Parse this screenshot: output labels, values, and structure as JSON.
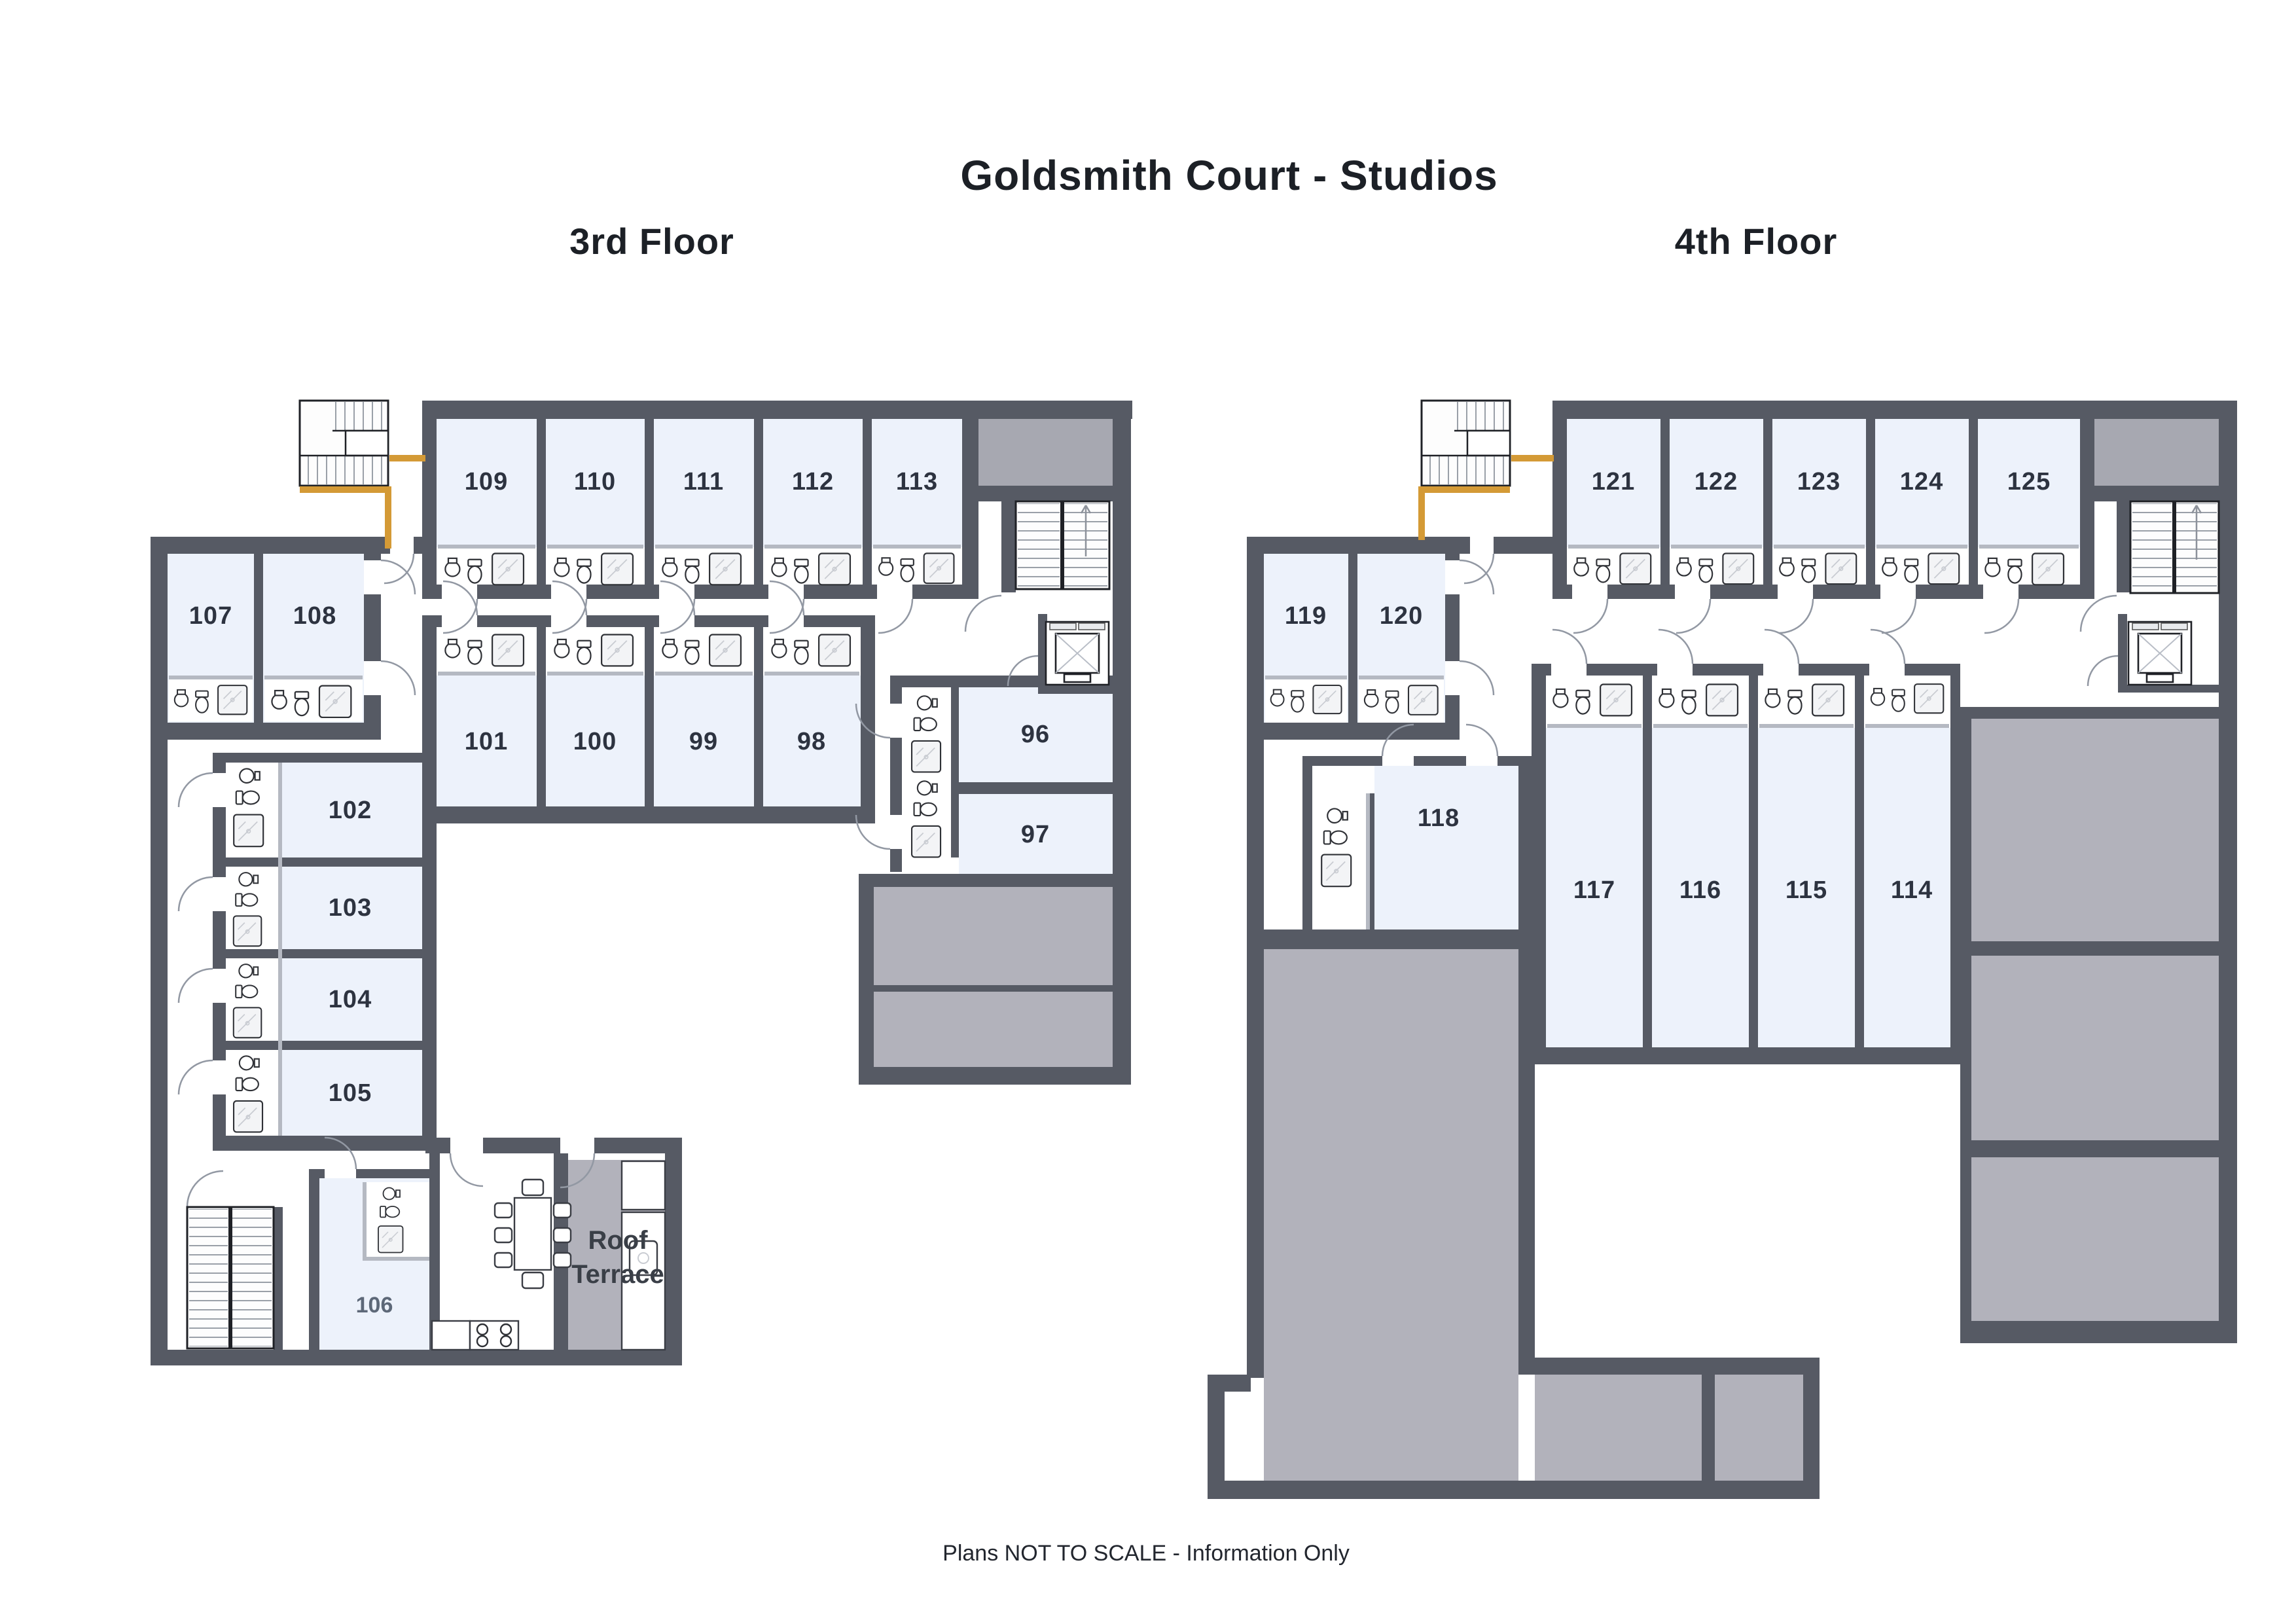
{
  "title": "Goldsmith Court - Studios",
  "footer": "Plans NOT TO SCALE - Information Only",
  "labels": {
    "roof": "Roof",
    "terrace": "Terrace"
  },
  "floors": [
    {
      "name": "3rd Floor",
      "rooms": {
        "96": "96",
        "97": "97",
        "98": "98",
        "99": "99",
        "100": "100",
        "101": "101",
        "102": "102",
        "103": "103",
        "104": "104",
        "105": "105",
        "106": "106",
        "107": "107",
        "108": "108",
        "109": "109",
        "110": "110",
        "111": "111",
        "112": "112",
        "113": "113"
      }
    },
    {
      "name": "4th Floor",
      "rooms": {
        "114": "114",
        "115": "115",
        "116": "116",
        "117": "117",
        "118": "118",
        "119": "119",
        "120": "120",
        "121": "121",
        "122": "122",
        "123": "123",
        "124": "124",
        "125": "125"
      }
    }
  ],
  "colors": {
    "wall": "#565a64",
    "room_fill": "#edf2fb",
    "roof_area": "#b2b2bb",
    "roof_block": "#a7a8b1",
    "railing": "#d49a36"
  }
}
